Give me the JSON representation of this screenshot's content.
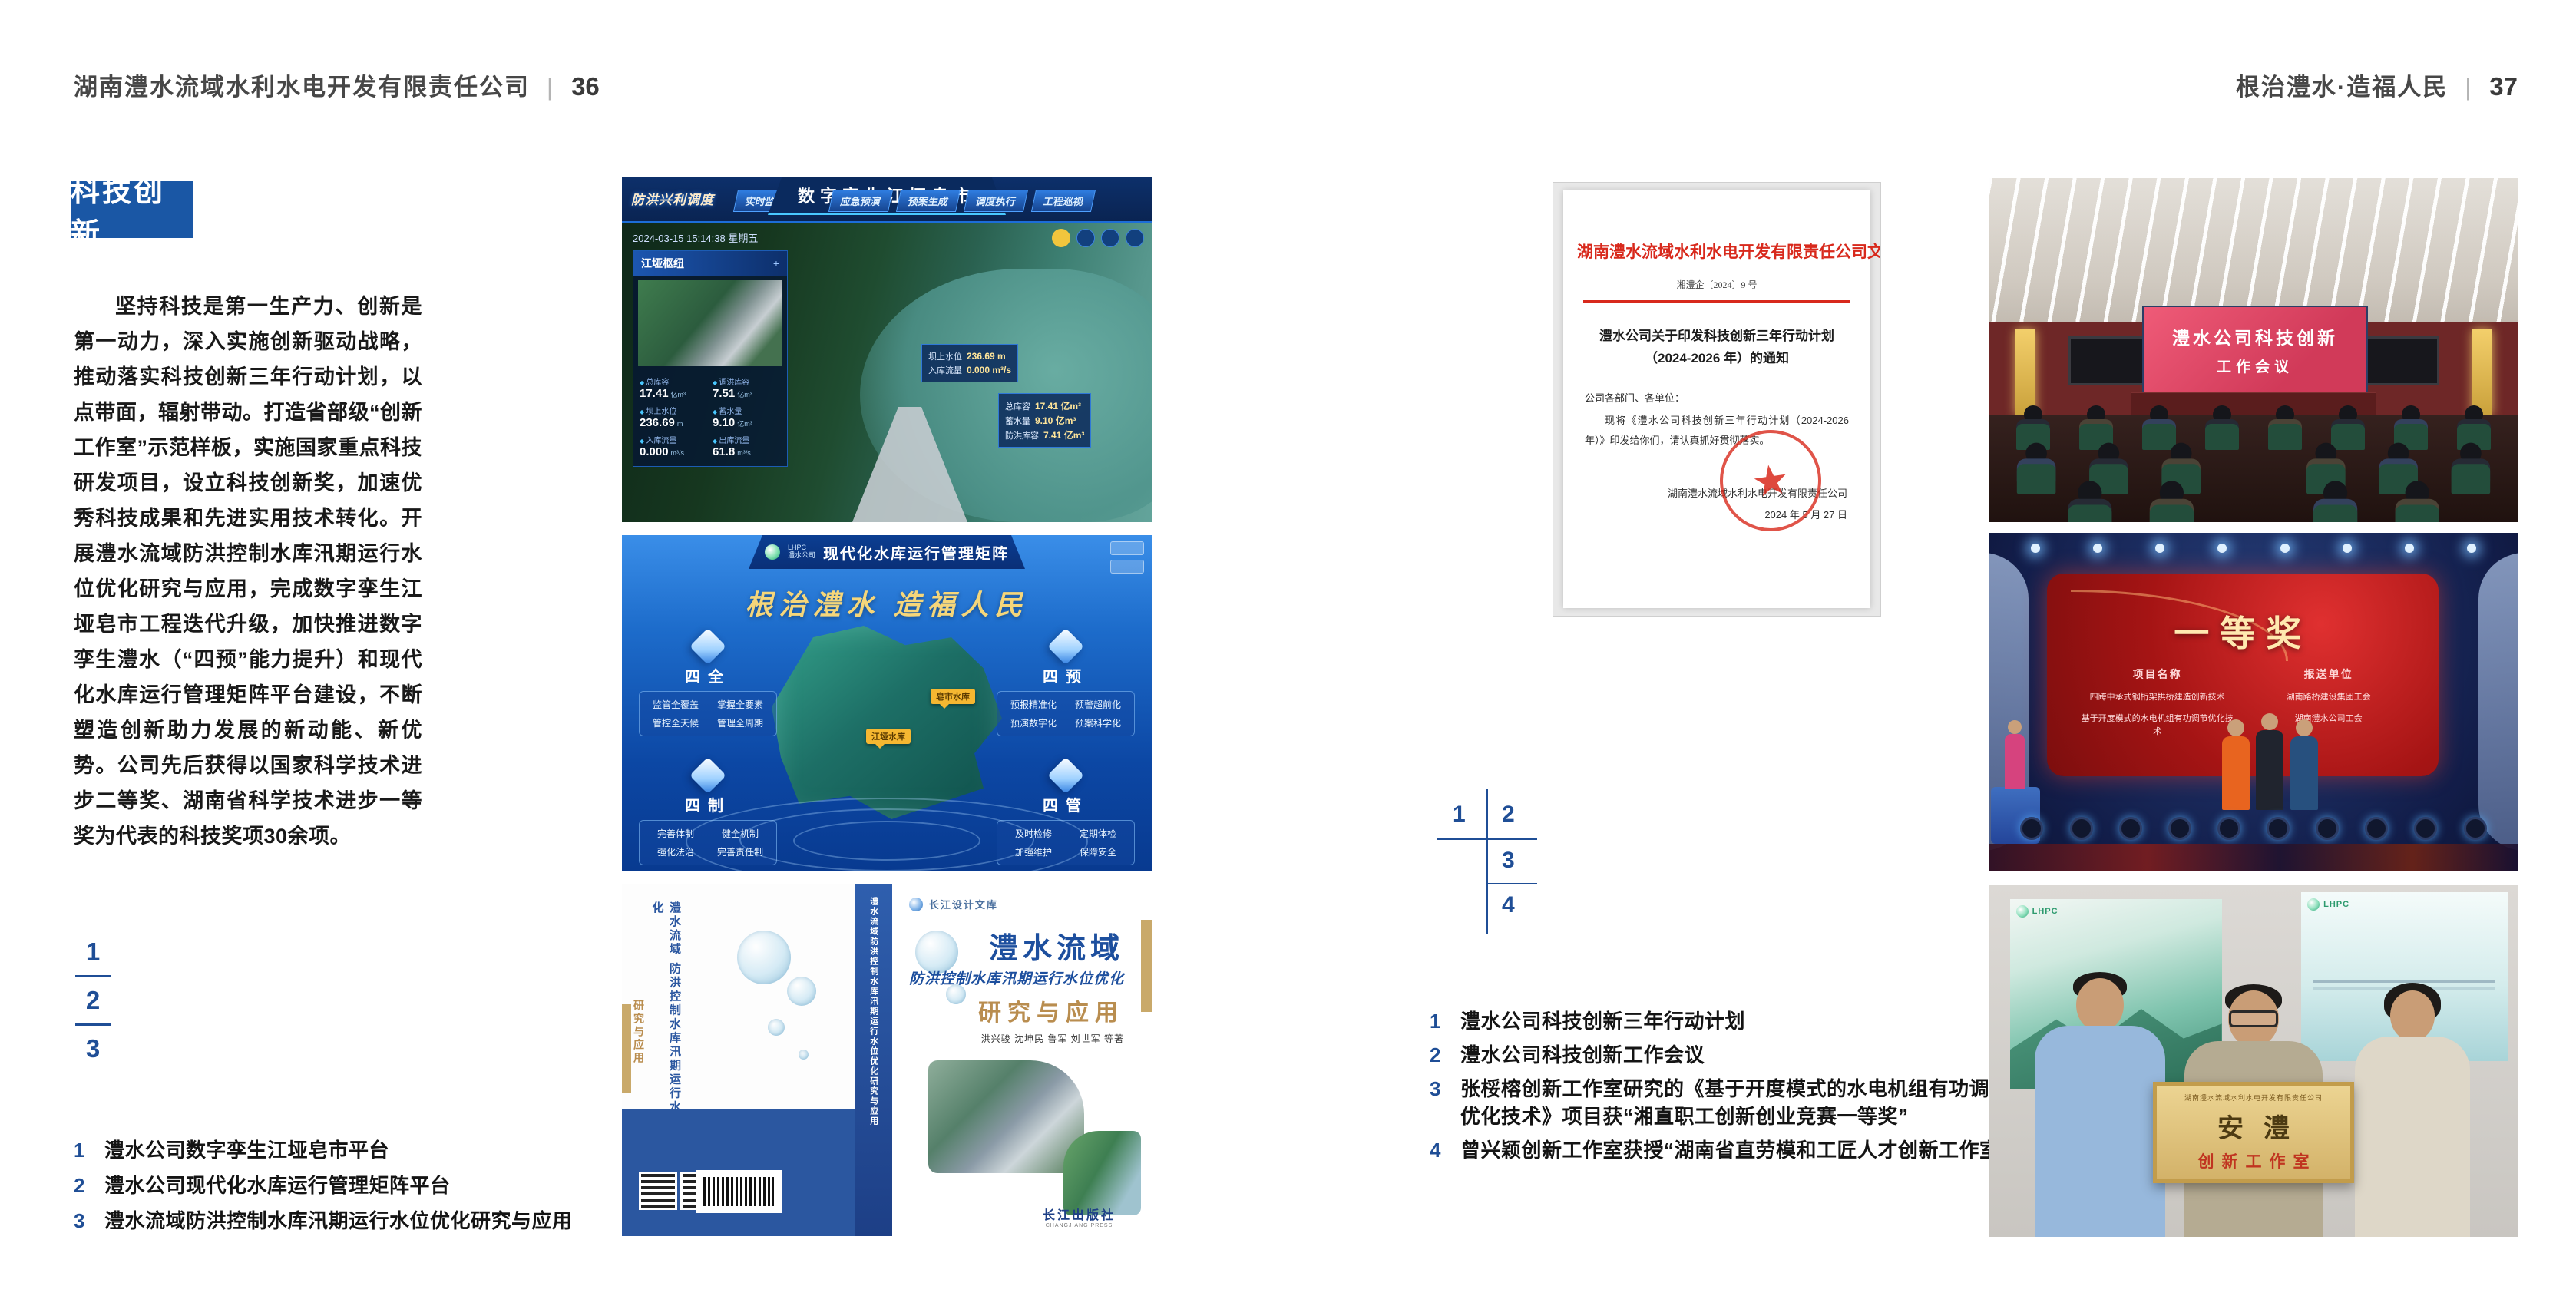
{
  "header_left": {
    "company": "湖南澧水流域水利水电开发有限责任公司",
    "divider": "|",
    "page": "36"
  },
  "header_right": {
    "slogan": "根治澧水·造福人民",
    "divider": "|",
    "page": "37"
  },
  "left_page": {
    "section_title": "科技创新",
    "body": "坚持科技是第一生产力、创新是第一动力，深入实施创新驱动战略，推动落实科技创新三年行动计划，以点带面，辐射带动。打造省部级“创新工作室”示范样板，实施国家重点科技研发项目，设立科技创新奖，加速优秀科技成果和先进实用技术转化。开展澧水流域防洪控制水库汛期运行水位优化研究与应用，完成数字孪生江垭皂市工程迭代升级，加快推进数字孪生澧水（“四预”能力提升）和现代化水库运行管理矩阵平台建设，不断塑造创新助力发展的新动能、新优势。公司先后获得以国家科学技术进步二等奖、湖南省科学技术进步一等奖为代表的科技奖项30余项。",
    "index": [
      "1",
      "2",
      "3"
    ],
    "captions": [
      {
        "no": "1",
        "text": "澧水公司数字孪生江垭皂市平台"
      },
      {
        "no": "2",
        "text": "澧水公司现代化水库运行管理矩阵平台"
      },
      {
        "no": "3",
        "text": "澧水流域防洪控制水库汛期运行水位优化研究与应用"
      }
    ]
  },
  "right_page": {
    "index": [
      "1",
      "2",
      "3",
      "4"
    ],
    "captions": [
      {
        "no": "1",
        "text": "澧水公司科技创新三年行动计划"
      },
      {
        "no": "2",
        "text": "澧水公司科技创新工作会议"
      },
      {
        "no": "3",
        "text": "张桵榕创新工作室研究的《基于开度模式的水电机组有功调节优化技术》项目获“湘直职工创新创业竞赛一等奖”"
      },
      {
        "no": "4",
        "text": "曾兴颖创新工作室获授“湖南省直劳模和工匠人才创新工作室”"
      }
    ]
  },
  "figures": {
    "dashboard": {
      "corner_label": "防洪兴利调度",
      "title": "数字孪生江垭皂市",
      "tabs_left": [
        "实时监测",
        "洪水预报",
        "防洪预警"
      ],
      "tabs_right": [
        "应急预演",
        "预案生成",
        "调度执行",
        "工程巡视"
      ],
      "datetime": "2024-03-15 15:14:38 星期五",
      "panel_title": "江垭枢纽",
      "panel_plus": "+",
      "stats": [
        {
          "label": "总库容",
          "value": "17.41",
          "unit": "亿m³"
        },
        {
          "label": "调洪库容",
          "value": "7.51",
          "unit": "亿m³"
        },
        {
          "label": "坝上水位",
          "value": "236.69",
          "unit": "m"
        },
        {
          "label": "蓄水量",
          "value": "9.10",
          "unit": "亿m³"
        },
        {
          "label": "入库流量",
          "value": "0.000",
          "unit": "m³/s"
        },
        {
          "label": "出库流量",
          "value": "61.8",
          "unit": "m³/s"
        }
      ],
      "tag": {
        "label1": "坝上水位",
        "value1": "236.69 m",
        "label2": "入库流量",
        "value2": "0.000 m³/s"
      },
      "card": [
        {
          "label": "总库容",
          "value": "17.41 亿m³"
        },
        {
          "label": "蓄水量",
          "value": "9.10 亿m³"
        },
        {
          "label": "防洪库容",
          "value": "7.41 亿m³"
        }
      ]
    },
    "matrix": {
      "logo_en": "LHPC",
      "logo": "澧水公司",
      "title": "现代化水库运行管理矩阵",
      "slogan": "根治澧水 造福人民",
      "panels": [
        {
          "name": "四全",
          "items": [
            "监管全覆盖",
            "掌握全要素",
            "管控全天候",
            "管理全周期"
          ]
        },
        {
          "name": "四预",
          "items": [
            "预报精准化",
            "预警超前化",
            "预演数字化",
            "预案科学化"
          ]
        },
        {
          "name": "四制",
          "items": [
            "完善体制",
            "健全机制",
            "强化法治",
            "完善责任制"
          ]
        },
        {
          "name": "四管",
          "items": [
            "及时检修",
            "定期体检",
            "加强维护",
            "保障安全"
          ]
        }
      ],
      "map_labels": [
        "江垭水库",
        "皂市水库"
      ]
    },
    "book": {
      "series": "长江设计文库",
      "title_main": "澧水流域",
      "title_sub": "防洪控制水库汛期运行水位优化",
      "title_tail": "研究与应用",
      "authors": "洪兴骏 沈坤民 鲁军 刘世军 等著",
      "spine": "澧水流域防洪控制水库汛期运行水位优化研究与应用",
      "back_title": "澧水流域 防洪控制水库汛期运行水位优化",
      "back_tail": "研究与应用",
      "publisher": "长江出版社",
      "publisher_en": "CHANGJIANG PRESS"
    },
    "document": {
      "header": "湖南澧水流域水利水电开发有限责任公司文件",
      "doc_no": "湘澧企〔2024〕9 号",
      "title": "澧水公司关于印发科技创新三年行动计划（2024-2026 年）的通知",
      "salutation": "公司各部门、各单位：",
      "body": "现将《澧水公司科技创新三年行动计划（2024-2026 年）》印发给你们，请认真抓好贯彻落实。",
      "signer": "湖南澧水流域水利水电开发有限责任公司",
      "date": "2024 年 5 月 27 日"
    },
    "meeting": {
      "screen_line1": "澧水公司科技创新",
      "screen_line2": "工作会议"
    },
    "award": {
      "title": "一等奖",
      "col1": "项目名称",
      "col2": "报送单位",
      "rows": [
        {
          "project": "四跨中承式钢桁架拱桥建造创新技术",
          "org": "湖南路桥建设集团工会"
        },
        {
          "project": "基于开度模式的水电机组有功调节优化技术",
          "org": "湖南澧水公司工会"
        }
      ]
    },
    "plaque": {
      "org": "湖南澧水流域水利水电开发有限责任公司",
      "name": "安澧",
      "sub": "创新工作室",
      "poster_logo": "LHPC"
    }
  }
}
